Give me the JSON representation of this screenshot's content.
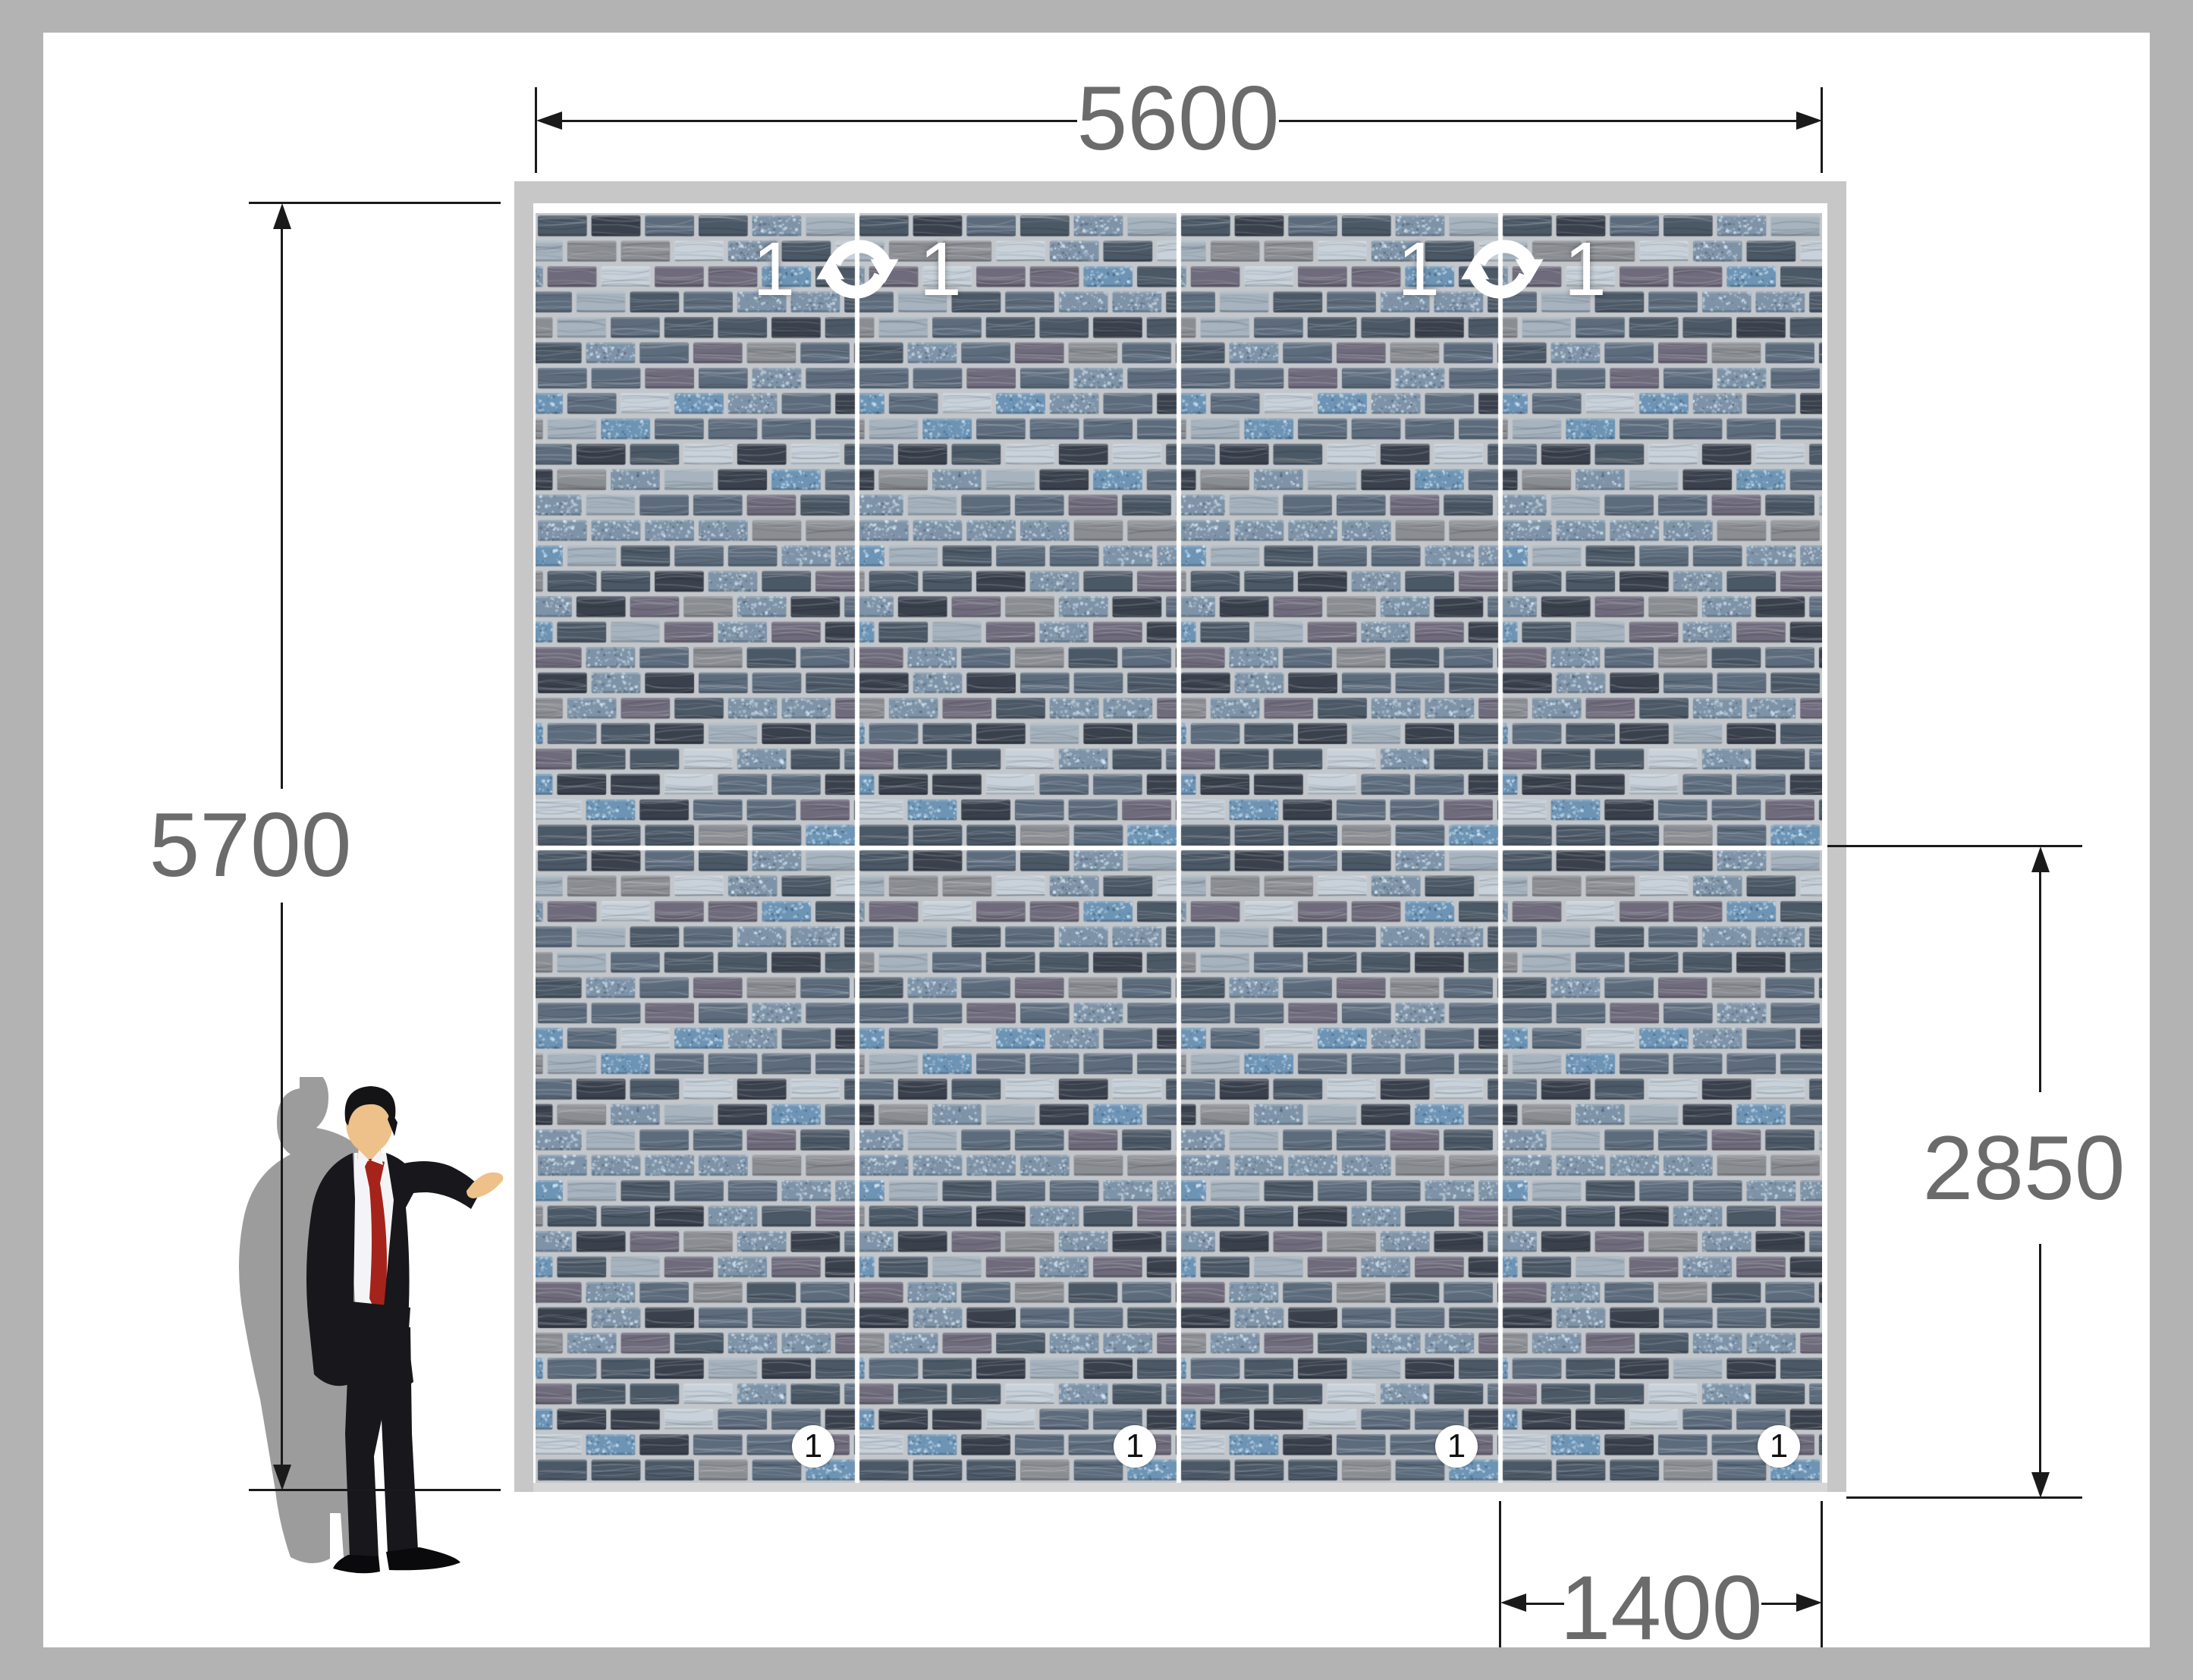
{
  "canvas_border_color": "#b3b3b3",
  "dimensions": {
    "line_color": "#1a1a1a",
    "text_color": "#6b6b6b",
    "width": {
      "value": "5600"
    },
    "height": {
      "value": "5700"
    },
    "lower_height": {
      "value": "2850"
    },
    "panel_width": {
      "value": "1400"
    }
  },
  "rotation_markers": [
    {
      "left_label": "1",
      "right_label": "1"
    },
    {
      "left_label": "1",
      "right_label": "1"
    }
  ],
  "panel_badges": [
    "1",
    "1",
    "1",
    "1"
  ],
  "wall": {
    "rows": 2,
    "columns": 4,
    "frame_color": "#c7c7c7",
    "bottom_strip_color": "#d6d6d6",
    "separator_color": "#ffffff",
    "grout_color": "#c3c7cb",
    "rotation_icon_color": "#ffffff",
    "tile_palette": [
      {
        "color": "#3a414d",
        "type": "stone",
        "weight": 0.14
      },
      {
        "color": "#4b5866",
        "type": "stone",
        "weight": 0.13
      },
      {
        "color": "#5d6c7d",
        "type": "stone",
        "weight": 0.15
      },
      {
        "color": "#6f6b7c",
        "type": "stone",
        "weight": 0.12
      },
      {
        "color": "#8a8d92",
        "type": "stone",
        "weight": 0.08
      },
      {
        "color": "#7e93a7",
        "type": "speckle",
        "weight": 0.12
      },
      {
        "color": "#6d94b5",
        "type": "speckle",
        "weight": 0.07
      },
      {
        "color": "#a7b4bf",
        "type": "pale",
        "weight": 0.1
      },
      {
        "color": "#c9d2da",
        "type": "pale",
        "weight": 0.09
      }
    ]
  },
  "presenter": {
    "suit": "#17171c",
    "shirt": "#f4f4f6",
    "tie": "#a5231a",
    "skin": "#eec08a",
    "hair": "#141417",
    "shoes": "#0a0a0c",
    "shadow": "#9c9c9c"
  }
}
